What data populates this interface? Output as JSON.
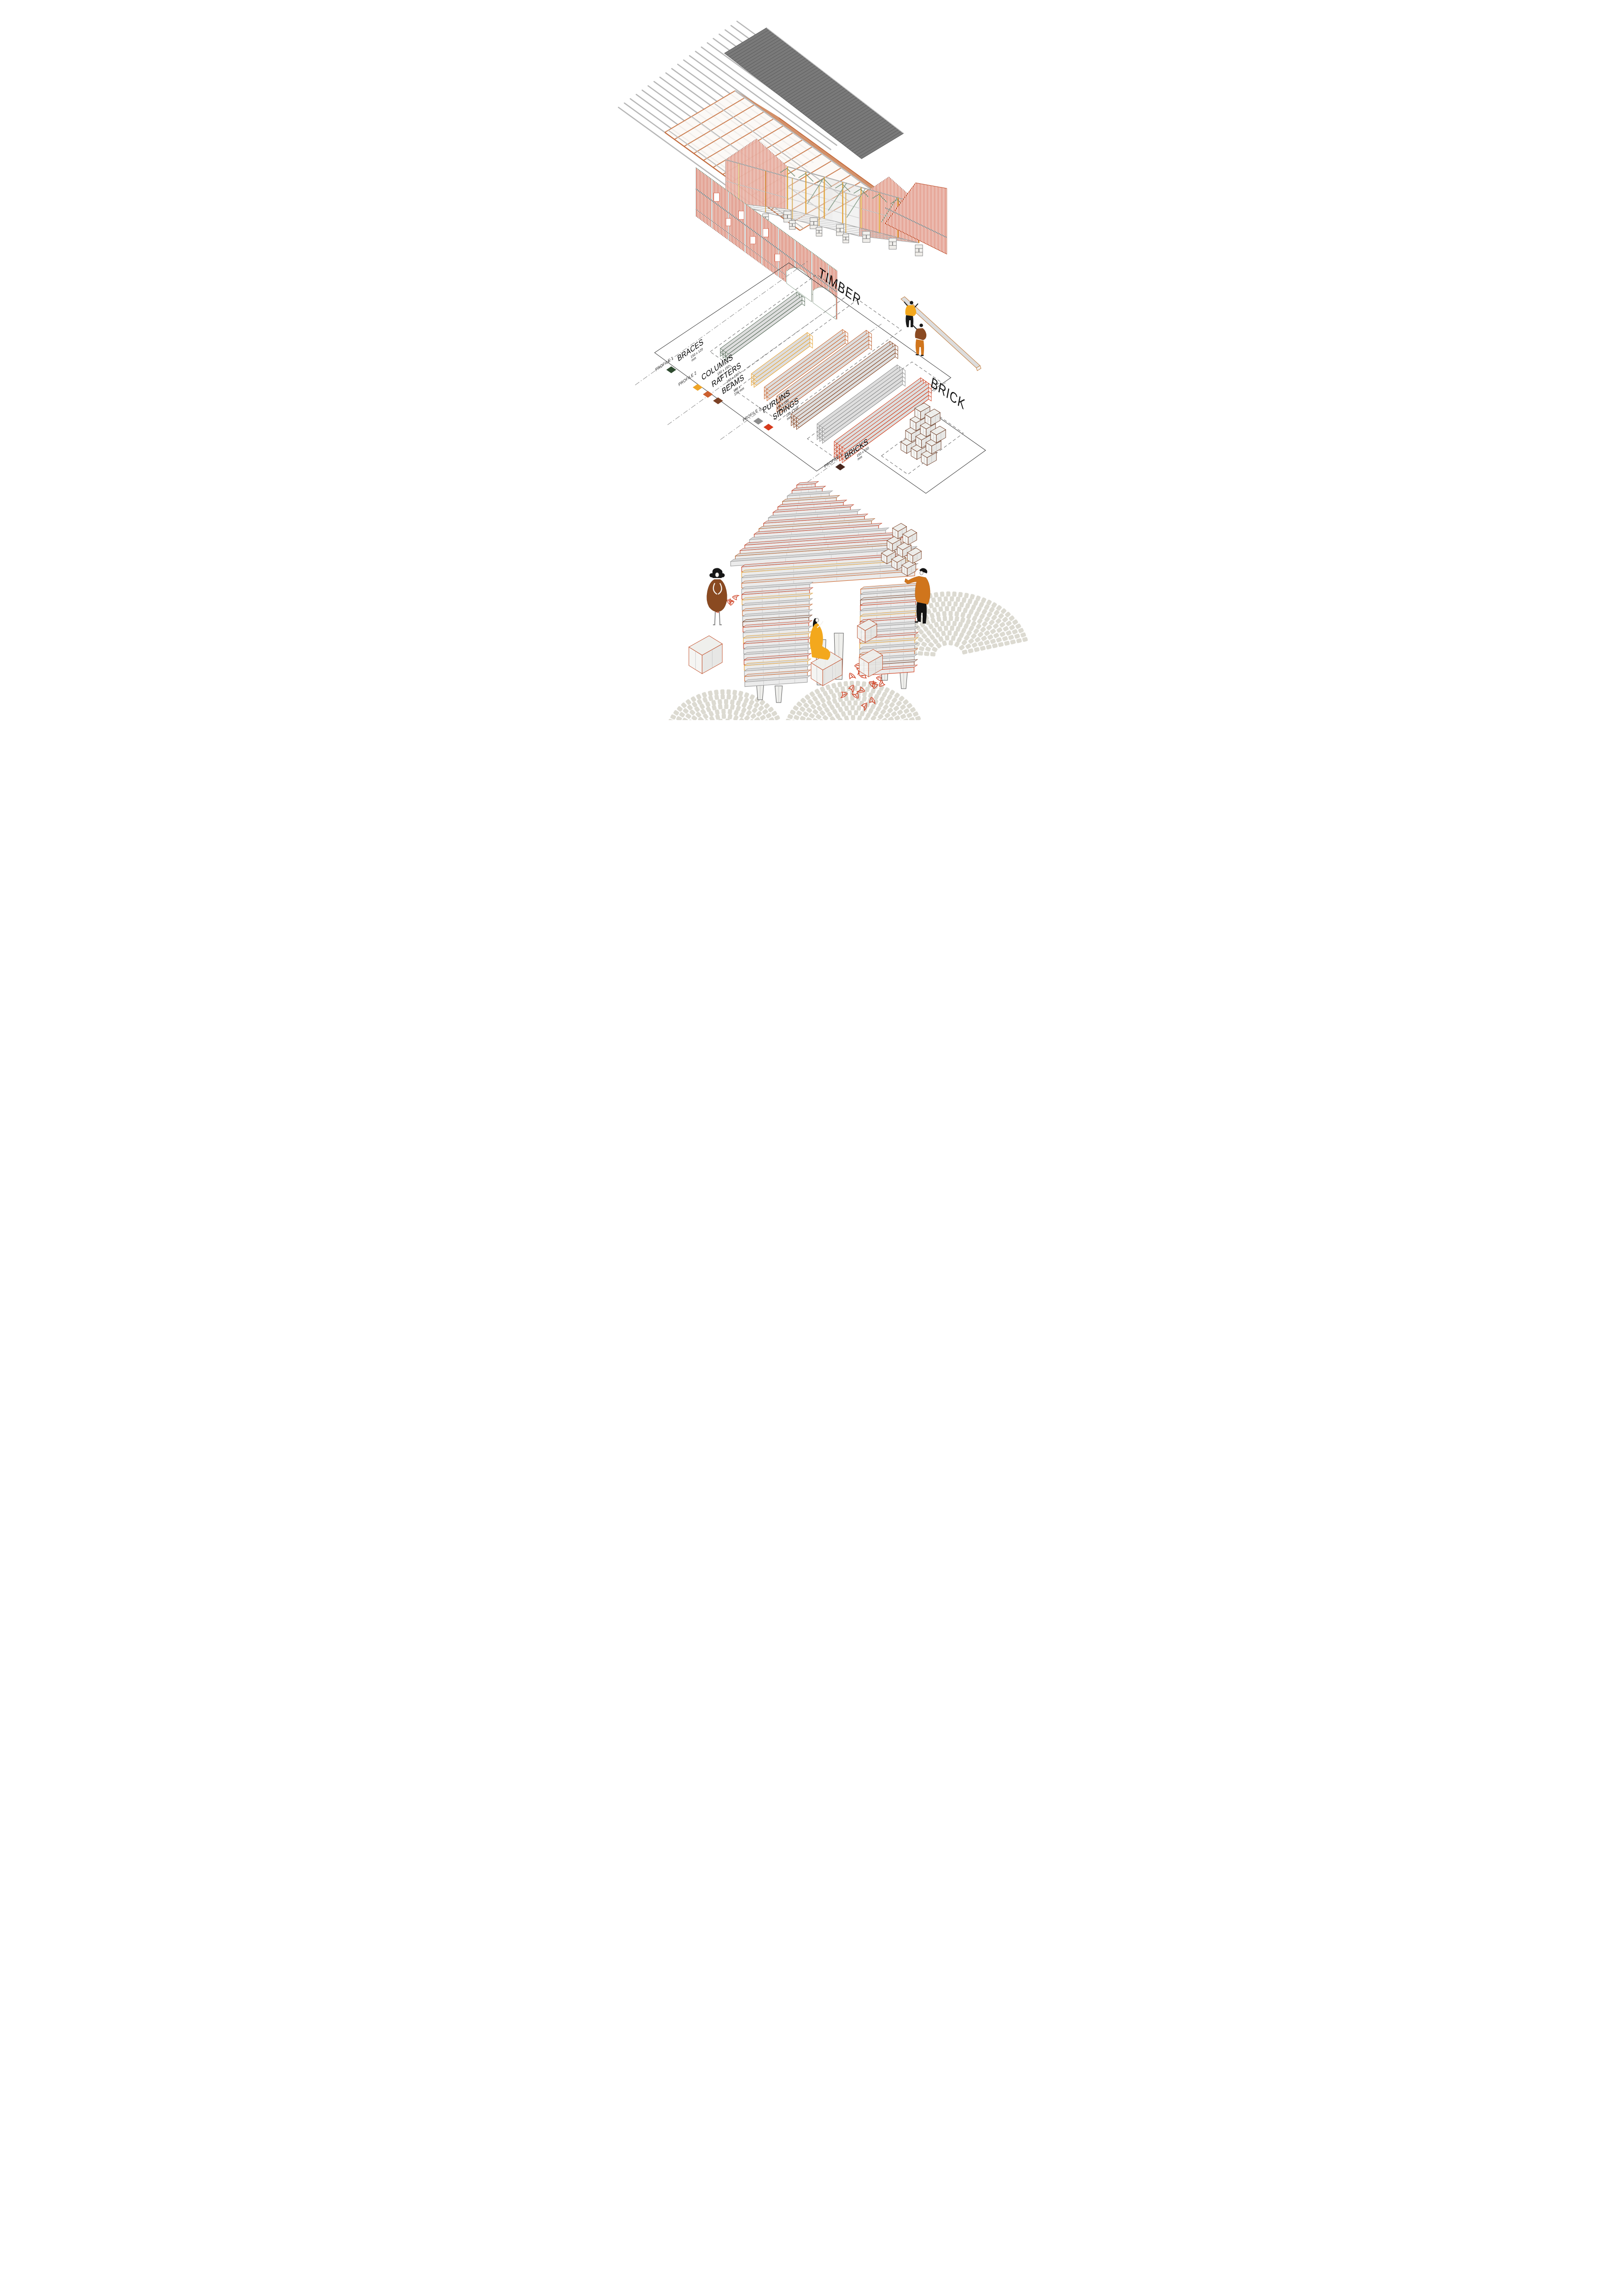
{
  "materials_map": {
    "timber_label": "TIMBER",
    "brick_label": "BRICK"
  },
  "legends": [
    {
      "profile": "PROFILE 1",
      "items": [
        {
          "label": "BRACES",
          "dims": "150 x 120 mm",
          "color": "#2e4a2f"
        }
      ]
    },
    {
      "profile": "PROFILE 2",
      "items": [
        {
          "label": "COLUMNS",
          "dims": "150 x 150 mm",
          "color": "#eea427"
        },
        {
          "label": "RAFTERS",
          "dims": "150 x 150 mm",
          "color": "#cb5f2e"
        },
        {
          "label": "BEAMS",
          "dims": "150 x 150 mm",
          "color": "#7c4125"
        }
      ]
    },
    {
      "profile": "PROFILE 3",
      "items": [
        {
          "label": "PURLINS",
          "dims": "150 x 150 mm",
          "color": "#8c8c8c"
        },
        {
          "label": "SIDINGS",
          "dims": "150 x 150 mm",
          "color": "#d63a1c"
        }
      ]
    },
    {
      "profile": "PROFILE 1",
      "items": [
        {
          "label": "BRICKS",
          "dims": "150 x 150 mm",
          "color": "#47261d"
        }
      ]
    }
  ],
  "palette": {
    "roof_sheet_gray": "#7a7a7a",
    "purlin_gray": "#b7b7b7",
    "rafter_orange": "#cd8256",
    "column_yellow": "#e2a43c",
    "brace_green": "#7b947e",
    "siding_red": "#cf3a1e",
    "beam_brown": "#8a4a28",
    "brick_brown": "#7c4125",
    "cobblestone_gray": "#dcdad1",
    "leaf_red": "#d0472a",
    "worker_shirt_yellow": "#f3a81d",
    "worker_coat_orange": "#d0751c",
    "dress_brown": "#8a4a21"
  }
}
